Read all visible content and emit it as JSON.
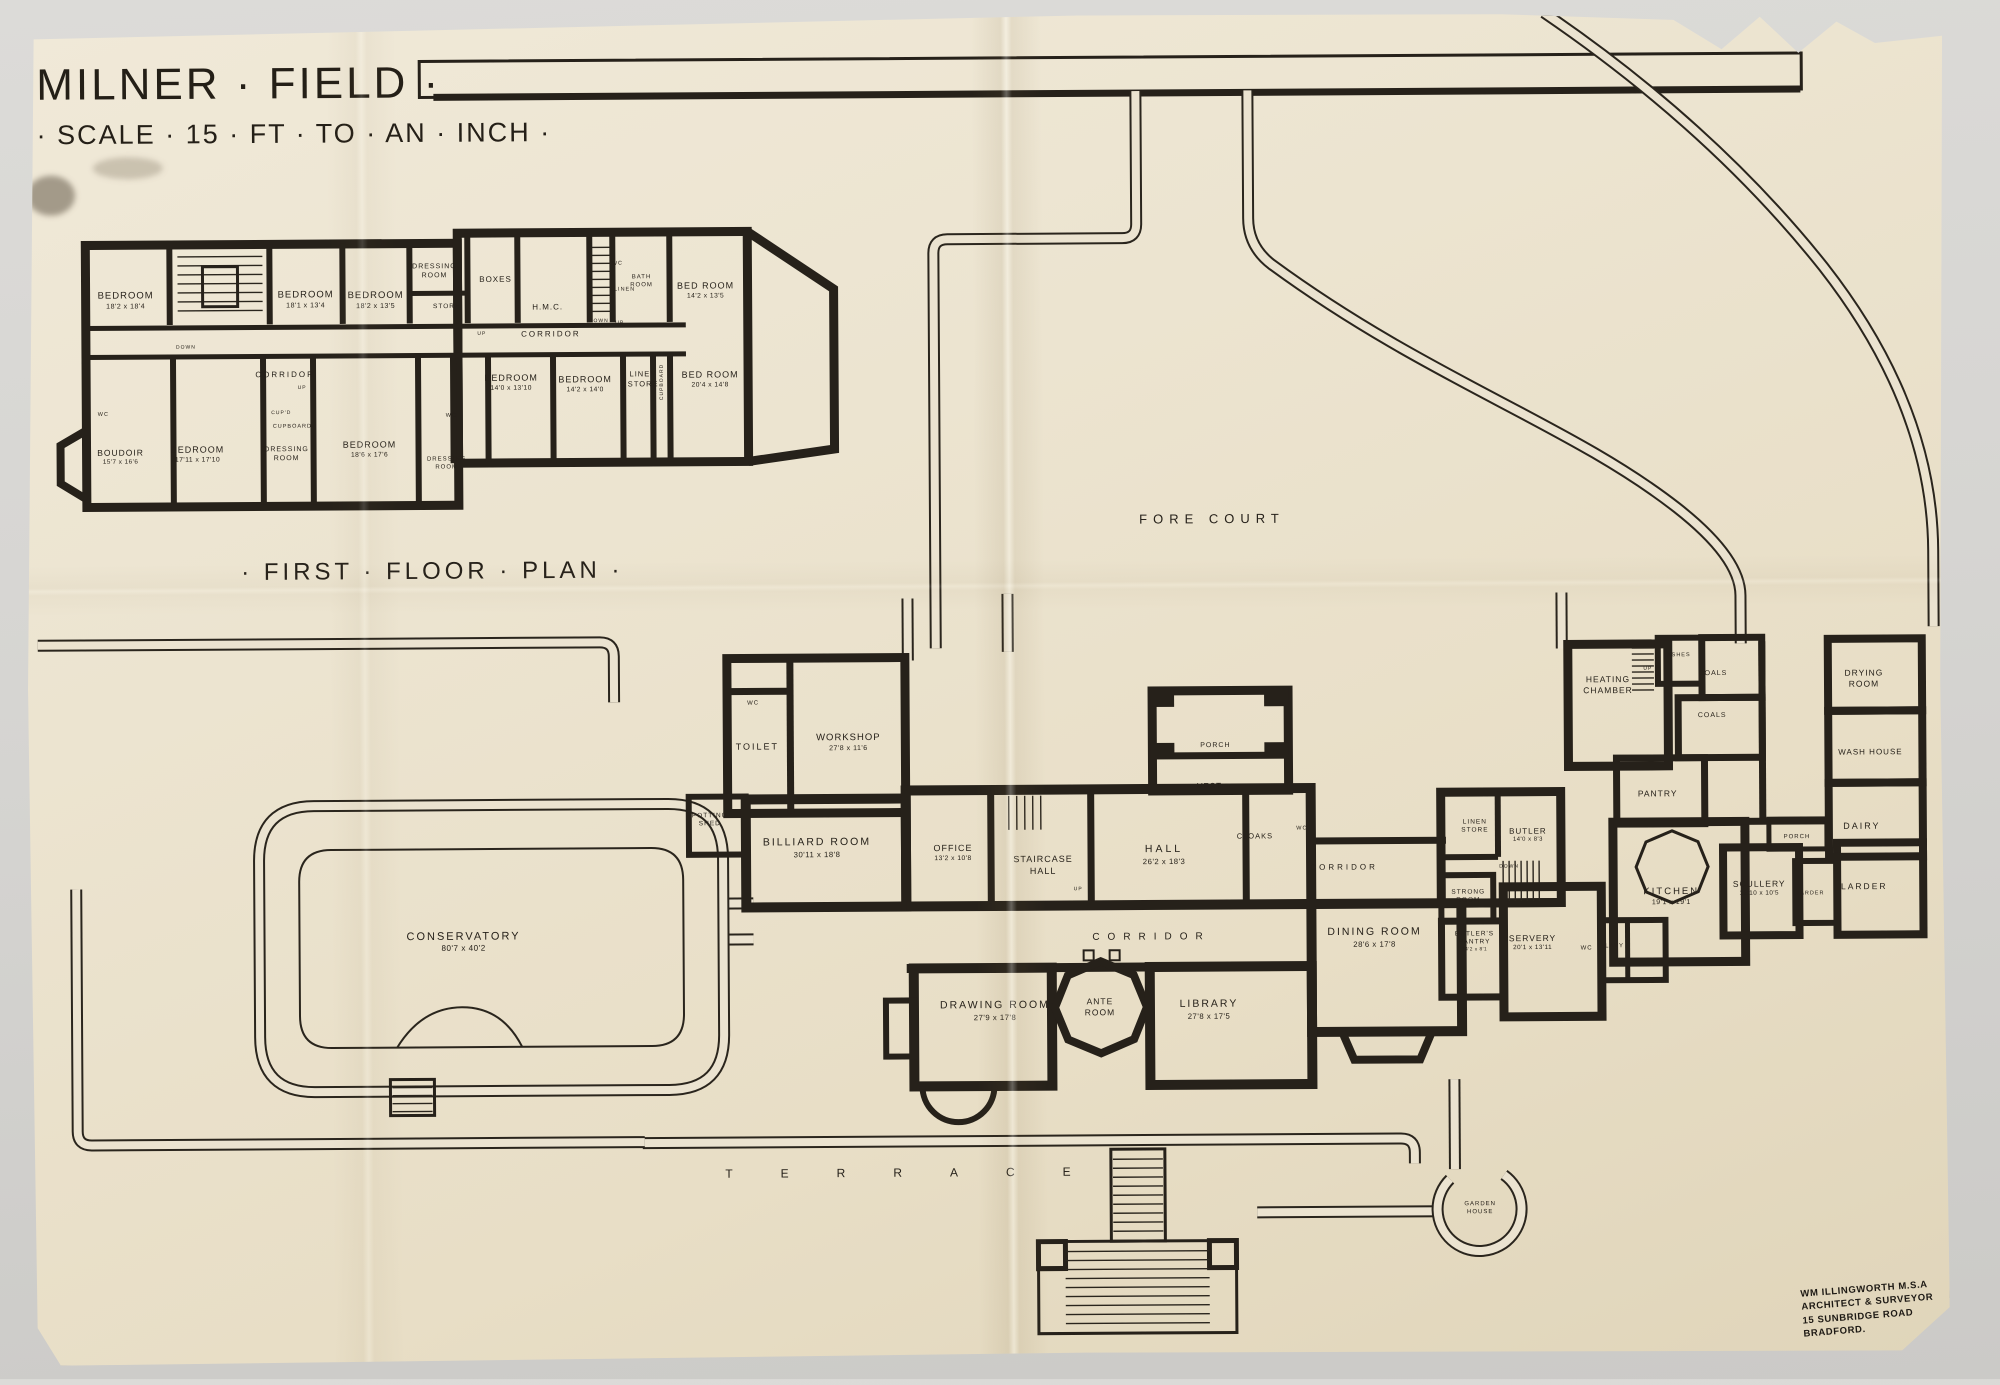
{
  "photo": {
    "background_color": "#d6d5d2",
    "paper_color": "#ebe3d0",
    "ink_color": "#26211a"
  },
  "sheet": {
    "title": {
      "name_line": "MILNER · FIELD ·",
      "scale_line": "· SCALE · 15 · FT · TO · AN · INCH ·"
    },
    "first_floor_plan": {
      "labels": [
        {
          "id": "ff-caption",
          "t": "· FIRST · FLOOR · PLAN ·",
          "x": 433,
          "y": 568,
          "fs": 24,
          "ls": 4
        },
        {
          "id": "ff-bedroom-1",
          "t": "BEDROOM",
          "d": "18'2 x 18'4",
          "x": 128,
          "y": 296,
          "fs": 9.5
        },
        {
          "id": "ff-bedroom-2",
          "t": "BEDROOM",
          "d": "18'1 x 13'4",
          "x": 308,
          "y": 296,
          "fs": 9.5
        },
        {
          "id": "ff-bedroom-3",
          "t": "BEDROOM",
          "d": "18'2 x 13'5",
          "x": 378,
          "y": 297,
          "fs": 9.5
        },
        {
          "id": "ff-dressing-room-1",
          "t": "DRESSING\nROOM",
          "x": 437,
          "y": 268,
          "fs": 7
        },
        {
          "id": "ff-store",
          "t": "STORE",
          "x": 449,
          "y": 304,
          "fs": 6.5
        },
        {
          "id": "ff-boxes",
          "t": "BOXES",
          "x": 498,
          "y": 277,
          "fs": 8
        },
        {
          "id": "ff-hmc",
          "t": "H.M.C.",
          "x": 550,
          "y": 305,
          "fs": 8
        },
        {
          "id": "ff-corridor-left",
          "t": "CORRIDOR",
          "x": 287,
          "y": 371,
          "fs": 8,
          "ls": 2
        },
        {
          "id": "ff-corridor-right",
          "t": "CORRIDOR",
          "x": 553,
          "y": 332,
          "fs": 8,
          "ls": 2
        },
        {
          "id": "ff-wc-1",
          "t": "WC",
          "x": 620,
          "y": 262,
          "fs": 5.5
        },
        {
          "id": "ff-bath-room",
          "t": "BATH\nROOM",
          "x": 644,
          "y": 280,
          "fs": 6
        },
        {
          "id": "ff-linen",
          "t": "LINEN",
          "x": 627,
          "y": 288,
          "fs": 5.5
        },
        {
          "id": "ff-bedroom-4",
          "t": "BED ROOM",
          "d": "14'2 x 13'5",
          "x": 708,
          "y": 289,
          "fs": 9
        },
        {
          "id": "ff-bedroom-5",
          "t": "BEDROOM",
          "d": "14'0 x 13'10",
          "x": 513,
          "y": 380,
          "fs": 9
        },
        {
          "id": "ff-bedroom-6",
          "t": "BEDROOM",
          "d": "14'2 x 14'0",
          "x": 587,
          "y": 382,
          "fs": 9
        },
        {
          "id": "ff-linen-store",
          "t": "LINEN\nSTORE",
          "x": 645,
          "y": 377,
          "fs": 7.5
        },
        {
          "id": "ff-cupboard-v",
          "t": "CUPBOARD",
          "x": 664,
          "y": 380,
          "fs": 5,
          "rot": -90
        },
        {
          "id": "ff-bedroom-7",
          "t": "BED ROOM",
          "d": "20'4 x 14'8",
          "x": 712,
          "y": 378,
          "fs": 9
        },
        {
          "id": "ff-wc-2",
          "t": "WC",
          "x": 105,
          "y": 410,
          "fs": 5.5
        },
        {
          "id": "ff-boudoir",
          "t": "BOUDOIR",
          "d": "15'7 x 16'6",
          "x": 122,
          "y": 452,
          "fs": 8.5
        },
        {
          "id": "ff-bedroom-8",
          "t": "BEDROOM",
          "d": "17'11 x 17'10",
          "x": 199,
          "y": 450,
          "fs": 9
        },
        {
          "id": "ff-cupd",
          "t": "CUP'D",
          "x": 283,
          "y": 409,
          "fs": 5
        },
        {
          "id": "ff-cupboard-h",
          "t": "CUPBOARD",
          "x": 294,
          "y": 423,
          "fs": 5.5
        },
        {
          "id": "ff-dressing-room-2",
          "t": "DRESSING\nROOM",
          "x": 288,
          "y": 450,
          "fs": 7
        },
        {
          "id": "ff-bedroom-9",
          "t": "BEDROOM",
          "d": "18'6 x 17'6",
          "x": 371,
          "y": 446,
          "fs": 9
        },
        {
          "id": "ff-wc-3",
          "t": "WC",
          "x": 453,
          "y": 413,
          "fs": 5.5
        },
        {
          "id": "ff-dressing-room-3",
          "t": "DRESSING\nROOM",
          "x": 448,
          "y": 461,
          "fs": 6
        },
        {
          "id": "ff-down-1",
          "t": "DOWN",
          "x": 188,
          "y": 343,
          "fs": 5
        },
        {
          "id": "ff-up-1",
          "t": "UP",
          "x": 304,
          "y": 384,
          "fs": 5
        },
        {
          "id": "ff-up-2",
          "t": "UP",
          "x": 484,
          "y": 331,
          "fs": 5
        },
        {
          "id": "ff-down-2",
          "t": "DOWN",
          "x": 601,
          "y": 319,
          "fs": 5
        },
        {
          "id": "ff-up-3",
          "t": "UP",
          "x": 622,
          "y": 321,
          "fs": 5
        }
      ]
    },
    "ground_floor_plan": {
      "labels": [
        {
          "id": "gf-wc-1",
          "t": "WC",
          "x": 753,
          "y": 703,
          "fs": 6
        },
        {
          "id": "gf-toilet",
          "t": "TOILET",
          "x": 757,
          "y": 746,
          "fs": 9,
          "ls": 2
        },
        {
          "id": "gf-workshop",
          "t": "WORKSHOP",
          "d": "27'8 x 11'6",
          "x": 848,
          "y": 742,
          "fs": 9.5
        },
        {
          "id": "gf-potting-shed",
          "t": "POTTING\nSHED",
          "x": 709,
          "y": 819,
          "fs": 6.5
        },
        {
          "id": "gf-billiard-room",
          "t": "BILLIARD ROOM",
          "d": "30'11 x 18'8",
          "x": 816,
          "y": 847,
          "fs": 10.5,
          "ls": 2
        },
        {
          "id": "gf-office",
          "t": "OFFICE",
          "d": "13'2 x 10'8",
          "x": 952,
          "y": 853,
          "fs": 9
        },
        {
          "id": "gf-staircase-hall",
          "t": "STAIRCASE\nHALL",
          "x": 1042,
          "y": 866,
          "fs": 9
        },
        {
          "id": "gf-up-1",
          "t": "UP",
          "x": 1077,
          "y": 890,
          "fs": 5
        },
        {
          "id": "gf-porch-main",
          "t": "PORCH",
          "x": 1215,
          "y": 747,
          "fs": 7
        },
        {
          "id": "gf-vest",
          "t": "VEST",
          "x": 1209,
          "y": 788,
          "fs": 8
        },
        {
          "id": "gf-hall",
          "t": "HALL",
          "d": "26'2 x 18'3",
          "x": 1163,
          "y": 856,
          "fs": 10.5,
          "ls": 3
        },
        {
          "id": "gf-cloaks",
          "t": "CLOAKS",
          "x": 1254,
          "y": 838,
          "fs": 7.5
        },
        {
          "id": "gf-wc-2",
          "t": "WC",
          "x": 1301,
          "y": 831,
          "fs": 5.5
        },
        {
          "id": "gf-corridor-right",
          "t": "CORRIDOR",
          "x": 1343,
          "y": 870,
          "fs": 8,
          "ls": 3
        },
        {
          "id": "gf-linen-store",
          "t": "LINEN\nSTORE",
          "x": 1474,
          "y": 830,
          "fs": 6.5
        },
        {
          "id": "gf-butler",
          "t": "BUTLER",
          "d": "14'0 x 8'3",
          "x": 1527,
          "y": 839,
          "fs": 8
        },
        {
          "id": "gf-down-1",
          "t": "DOWN",
          "x": 1508,
          "y": 870,
          "fs": 5
        },
        {
          "id": "gf-strong-room",
          "t": "STRONG\nROOM",
          "x": 1467,
          "y": 900,
          "fs": 6.5
        },
        {
          "id": "gf-corridor-main",
          "t": "CORRIDOR",
          "x": 1146,
          "y": 938,
          "fs": 10,
          "ls": 8
        },
        {
          "id": "gf-dining-room",
          "t": "DINING ROOM",
          "d": "28'6 x 17'8",
          "x": 1373,
          "y": 940,
          "fs": 10.5,
          "ls": 2
        },
        {
          "id": "gf-butlers-pantry",
          "t": "BUTLER'S\nPANTRY",
          "d": "14'2 x 8'1",
          "x": 1473,
          "y": 945,
          "fs": 6.5
        },
        {
          "id": "gf-servery",
          "t": "SERVERY",
          "d": "20'1 x 13'11",
          "x": 1531,
          "y": 946,
          "fs": 8.5
        },
        {
          "id": "gf-wc-3",
          "t": "WC",
          "x": 1585,
          "y": 953,
          "fs": 6
        },
        {
          "id": "gf-lavy",
          "t": "LAVY",
          "x": 1613,
          "y": 951,
          "fs": 6
        },
        {
          "id": "gf-drawing-room",
          "t": "DRAWING ROOM",
          "d": "27'9 x 17'8",
          "x": 993,
          "y": 1011,
          "fs": 10.5,
          "ls": 2
        },
        {
          "id": "gf-ante-room",
          "t": "ANTE\nROOM",
          "x": 1098,
          "y": 1008,
          "fs": 8.5
        },
        {
          "id": "gf-library",
          "t": "LIBRARY",
          "d": "27'8 x 17'5",
          "x": 1207,
          "y": 1011,
          "fs": 10.5,
          "ls": 2
        },
        {
          "id": "gf-conservatory",
          "t": "CONSERVATORY",
          "d": "80'7 x 40'2",
          "x": 462,
          "y": 939,
          "fs": 11,
          "ls": 2
        },
        {
          "id": "gf-heating-chamber",
          "t": "HEATING\nCHAMBER",
          "x": 1608,
          "y": 689,
          "fs": 8.5
        },
        {
          "id": "gf-up-2",
          "t": "UP",
          "x": 1648,
          "y": 673,
          "fs": 5
        },
        {
          "id": "gf-ashes",
          "t": "ASHES",
          "x": 1679,
          "y": 660,
          "fs": 5.5
        },
        {
          "id": "gf-coals-1",
          "t": "COALS",
          "x": 1713,
          "y": 678,
          "fs": 7
        },
        {
          "id": "gf-coals-2",
          "t": "COALS",
          "x": 1712,
          "y": 720,
          "fs": 7
        },
        {
          "id": "gf-pantry",
          "t": "PANTRY",
          "x": 1657,
          "y": 798,
          "fs": 8.5
        },
        {
          "id": "gf-kitchen",
          "t": "KITCHEN",
          "d": "19'1 x 19'1",
          "x": 1670,
          "y": 901,
          "fs": 9.5,
          "ls": 2
        },
        {
          "id": "gf-scullery",
          "t": "SCULLERY",
          "d": "12'10 x 10'5",
          "x": 1758,
          "y": 893,
          "fs": 8.5
        },
        {
          "id": "gf-larder-small",
          "t": "LARDER",
          "x": 1809,
          "y": 899,
          "fs": 5.5
        },
        {
          "id": "gf-larder-large",
          "t": "LARDER",
          "x": 1863,
          "y": 892,
          "fs": 8.5,
          "ls": 2
        },
        {
          "id": "gf-porch-service",
          "t": "PORCH",
          "x": 1796,
          "y": 843,
          "fs": 6
        },
        {
          "id": "gf-dairy",
          "t": "DAIRY",
          "x": 1861,
          "y": 832,
          "fs": 9,
          "ls": 2
        },
        {
          "id": "gf-wash-house",
          "t": "WASH HOUSE",
          "x": 1870,
          "y": 758,
          "fs": 8
        },
        {
          "id": "gf-drying-room",
          "t": "DRYING\nROOM",
          "x": 1864,
          "y": 684,
          "fs": 8.5
        }
      ]
    },
    "site_labels": [
      {
        "id": "fore-court",
        "t": "FORE COURT",
        "x": 1213,
        "y": 521,
        "fs": 13,
        "ls": 6
      },
      {
        "id": "terrace",
        "t": "TERRACE",
        "x": 895,
        "y": 1173,
        "fs": 12,
        "ls": 48
      },
      {
        "id": "garden-house",
        "t": "GARDEN\nHOUSE",
        "x": 1477,
        "y": 1212,
        "fs": 6
      }
    ],
    "architect_stamp": {
      "lines": [
        "WM ILLINGWORTH M.S.A",
        "ARCHITECT & SURVEYOR",
        "15 SUNBRIDGE ROAD",
        "BRADFORD."
      ]
    }
  }
}
